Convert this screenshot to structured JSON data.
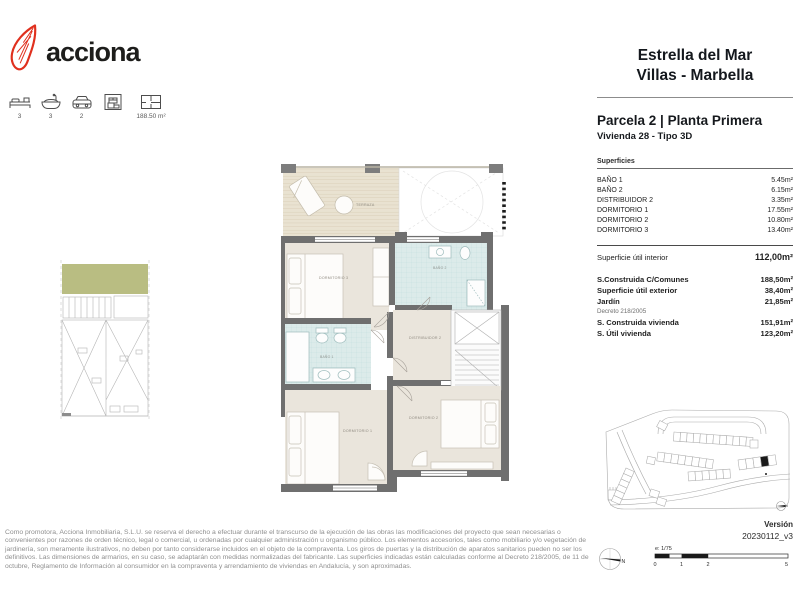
{
  "brand": {
    "name": "acciona",
    "logo_color": "#e0301e"
  },
  "property_stats": {
    "bedrooms": "3",
    "bathrooms": "3",
    "parking": "2",
    "storage": "",
    "built_area": "188.50 m²"
  },
  "header": {
    "project_line1": "Estrella del Mar",
    "project_line2": "Villas -  Marbella",
    "plot_title": "Parcela 2 | Planta Primera",
    "unit_subtitle": "Vivienda 28 - Tipo 3D"
  },
  "surfaces": {
    "section_label": "Superficies",
    "rooms": [
      {
        "label": "BAÑO 1",
        "value": "5.45m²"
      },
      {
        "label": "BAÑO 2",
        "value": "6.15m²"
      },
      {
        "label": "DISTRIBUIDOR 2",
        "value": "3.35m²"
      },
      {
        "label": "DORMITORIO 1",
        "value": "17.55m²"
      },
      {
        "label": "DORMITORIO 2",
        "value": "10.80m²"
      },
      {
        "label": "DORMITORIO 3",
        "value": "13.40m²"
      }
    ],
    "interior": {
      "label": "Superficie útil interior",
      "value": "112,00m²"
    },
    "summary": [
      {
        "label": "S.Construida C/Comunes",
        "value": "188,50m²"
      },
      {
        "label": "Superficie útil exterior",
        "value": "38,40m²"
      },
      {
        "label": "Jardín",
        "value": "21,85m²"
      }
    ],
    "decree_note": "Decreto 218/2005",
    "decree_rows": [
      {
        "label": "S. Construida vivienda",
        "value": "151,91m²"
      },
      {
        "label": "S. Útil vivienda",
        "value": "123,20m²"
      }
    ]
  },
  "floor_plan": {
    "labels": {
      "terraza": "TERRAZA",
      "dormitorio3": "DORMITORIO 3",
      "bano2": "BAÑO 2",
      "distribuidor2": "DISTRIBUIDOR 2",
      "bano1": "BAÑO 1",
      "dormitorio1": "DORMITORIO 1",
      "dormitorio2": "DORMITORIO 2"
    }
  },
  "footer": {
    "disclaimer": "Como promotora, Acciona Inmobiliaria, S.L.U. se reserva el derecho a efectuar durante el transcurso de la ejecución de las obras las modificaciones del proyecto que sean necesarias o convenientes por razones de orden técnico, legal o comercial, u ordenadas por cualquier administración u organismo público. Los elementos accesorios, tales como mobiliario y/o vegetación de jardinería, son meramente ilustrativos, no deben por tanto considerarse incluidos en el objeto de la compraventa. Los giros de puertas y la distribución de aparatos sanitarios pueden no ser los definitivos. Las dimensiones de armarios, en su caso, se adaptarán con medidas normalizadas del fabricante. Las superficies indicadas están calculadas conforme al Decreto 218/2005, de 11 de octubre, Reglamento de Información al consumidor en la compraventa y arrendamiento de viviendas en Andalucía, y son aproximadas."
  },
  "version": {
    "label": "Versión",
    "value": "20230112_v3"
  },
  "scale": {
    "label": "e: 1/75",
    "ticks": [
      "0",
      "1",
      "2",
      "5"
    ]
  },
  "compass": {
    "letter": "N"
  },
  "colors": {
    "logo_red": "#e0301e",
    "wall_gray": "#6f6f6f",
    "room_beige": "#eae5dc",
    "bath_blue": "#dcebea",
    "terrace_beige": "#e9e2d1",
    "garden_green": "#b9bd82"
  }
}
